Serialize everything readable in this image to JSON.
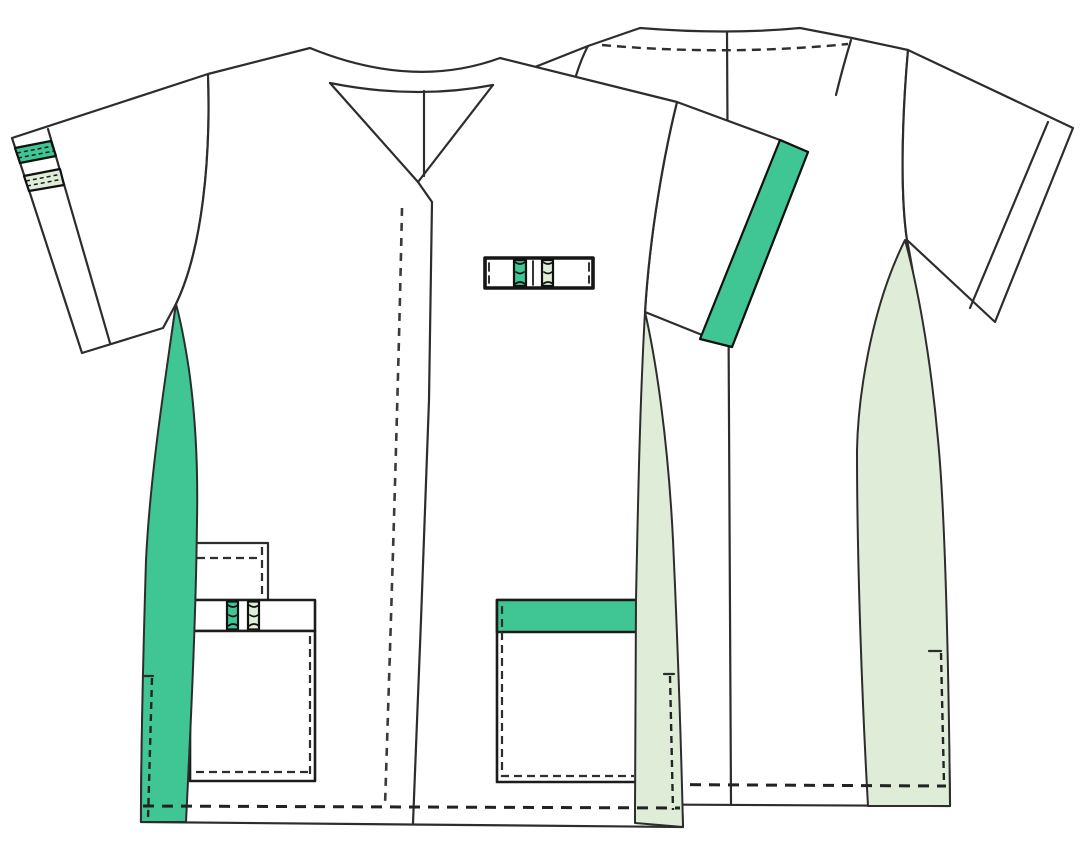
{
  "illustration": {
    "title": "short-sleeve v-neck medical tunic - technical flat sketch",
    "views": [
      {
        "id": "front",
        "parts": [
          "v-neck-collar-band",
          "center-front-placket",
          "placket-stitch-line",
          "left-sleeve-cuff-band",
          "sleeve-cuff-stripe-green",
          "sleeve-cuff-stripe-pale",
          "right-sleeve-green-band",
          "side-panel-green",
          "side-panel-pale",
          "chest-pen-pocket",
          "left-small-pocket",
          "left-pocket-stripe-band",
          "left-main-pocket",
          "right-pocket-green-band",
          "hem-stitch-line",
          "side-vent-stitches"
        ]
      },
      {
        "id": "back",
        "parts": [
          "back-yoke-stitch-line",
          "center-back-seam",
          "back-side-panel-pale",
          "back-sleeve-cuff-line",
          "back-hem-stitch-line",
          "back-vent-stitch",
          "back-armhole-notch"
        ]
      }
    ]
  },
  "colors": {
    "accent_green": "#3FC694",
    "pale_green": "#DFEDD8",
    "fabric_white": "#FFFFFF",
    "outline": "#2D2D2D",
    "detail_dark": "#161616"
  }
}
